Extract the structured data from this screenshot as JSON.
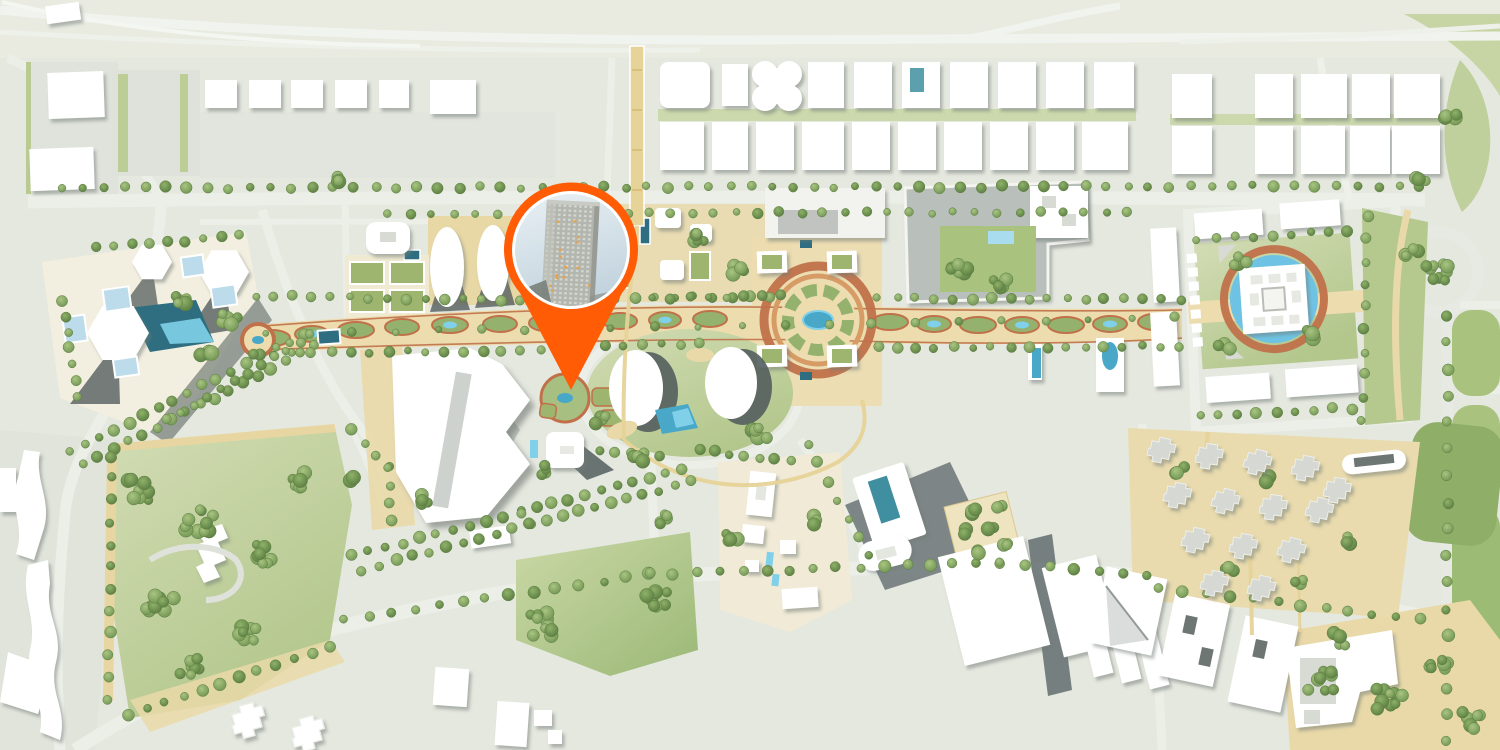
{
  "map": {
    "type": "aerial-master-plan-illustration",
    "district": "mixed-use-development",
    "marker": {
      "icon": "location-pin-icon",
      "photo_subject": "high-rise-tower",
      "color": "#ff5c05"
    },
    "palette": {
      "base": "#e5e8df",
      "top_band": "#e9ebe1",
      "road": "#eceee8",
      "road_bright": "#f3f5f0",
      "parcel_gray": "#e0e3dc",
      "cream": "#f3efe0",
      "sand": "#e9d9a8",
      "sand_light": "#efe4c0",
      "green_light": "#cfdaae",
      "green_mid": "#b2c78d",
      "green_park": "#a9c37f",
      "green_dark": "#8fae68",
      "court_green": "#9db56f",
      "tree_light": "#a9c581",
      "tree_mid": "#8fb269",
      "tree_dark": "#6d9150",
      "tree_shade": "#57793f",
      "tree_edge": "#5d7f42",
      "building_white": "#ffffff",
      "building_gray": "#d6d9d3",
      "roof_gray": "#8d9492",
      "shadow_dark": "#545e5e",
      "water_deep": "#2e6e80",
      "water_mid": "#49a8c8",
      "water_light": "#7fd0e8",
      "glass_blue": "#bcdcec",
      "pool_teal": "#3f8fa0",
      "terracotta": "#c0714a",
      "terracotta_light": "#d79c66",
      "plaza_tan": "#ecdcae",
      "path_yellow": "#e6d398",
      "pin_orange": "#ff5c05",
      "photo_sky_top": "#e9f0f4",
      "photo_sky_bottom": "#c3d4de",
      "photo_building": "#b3b6ae",
      "photo_window": "#d4d7cf",
      "lit_window": "#f0a040"
    }
  }
}
